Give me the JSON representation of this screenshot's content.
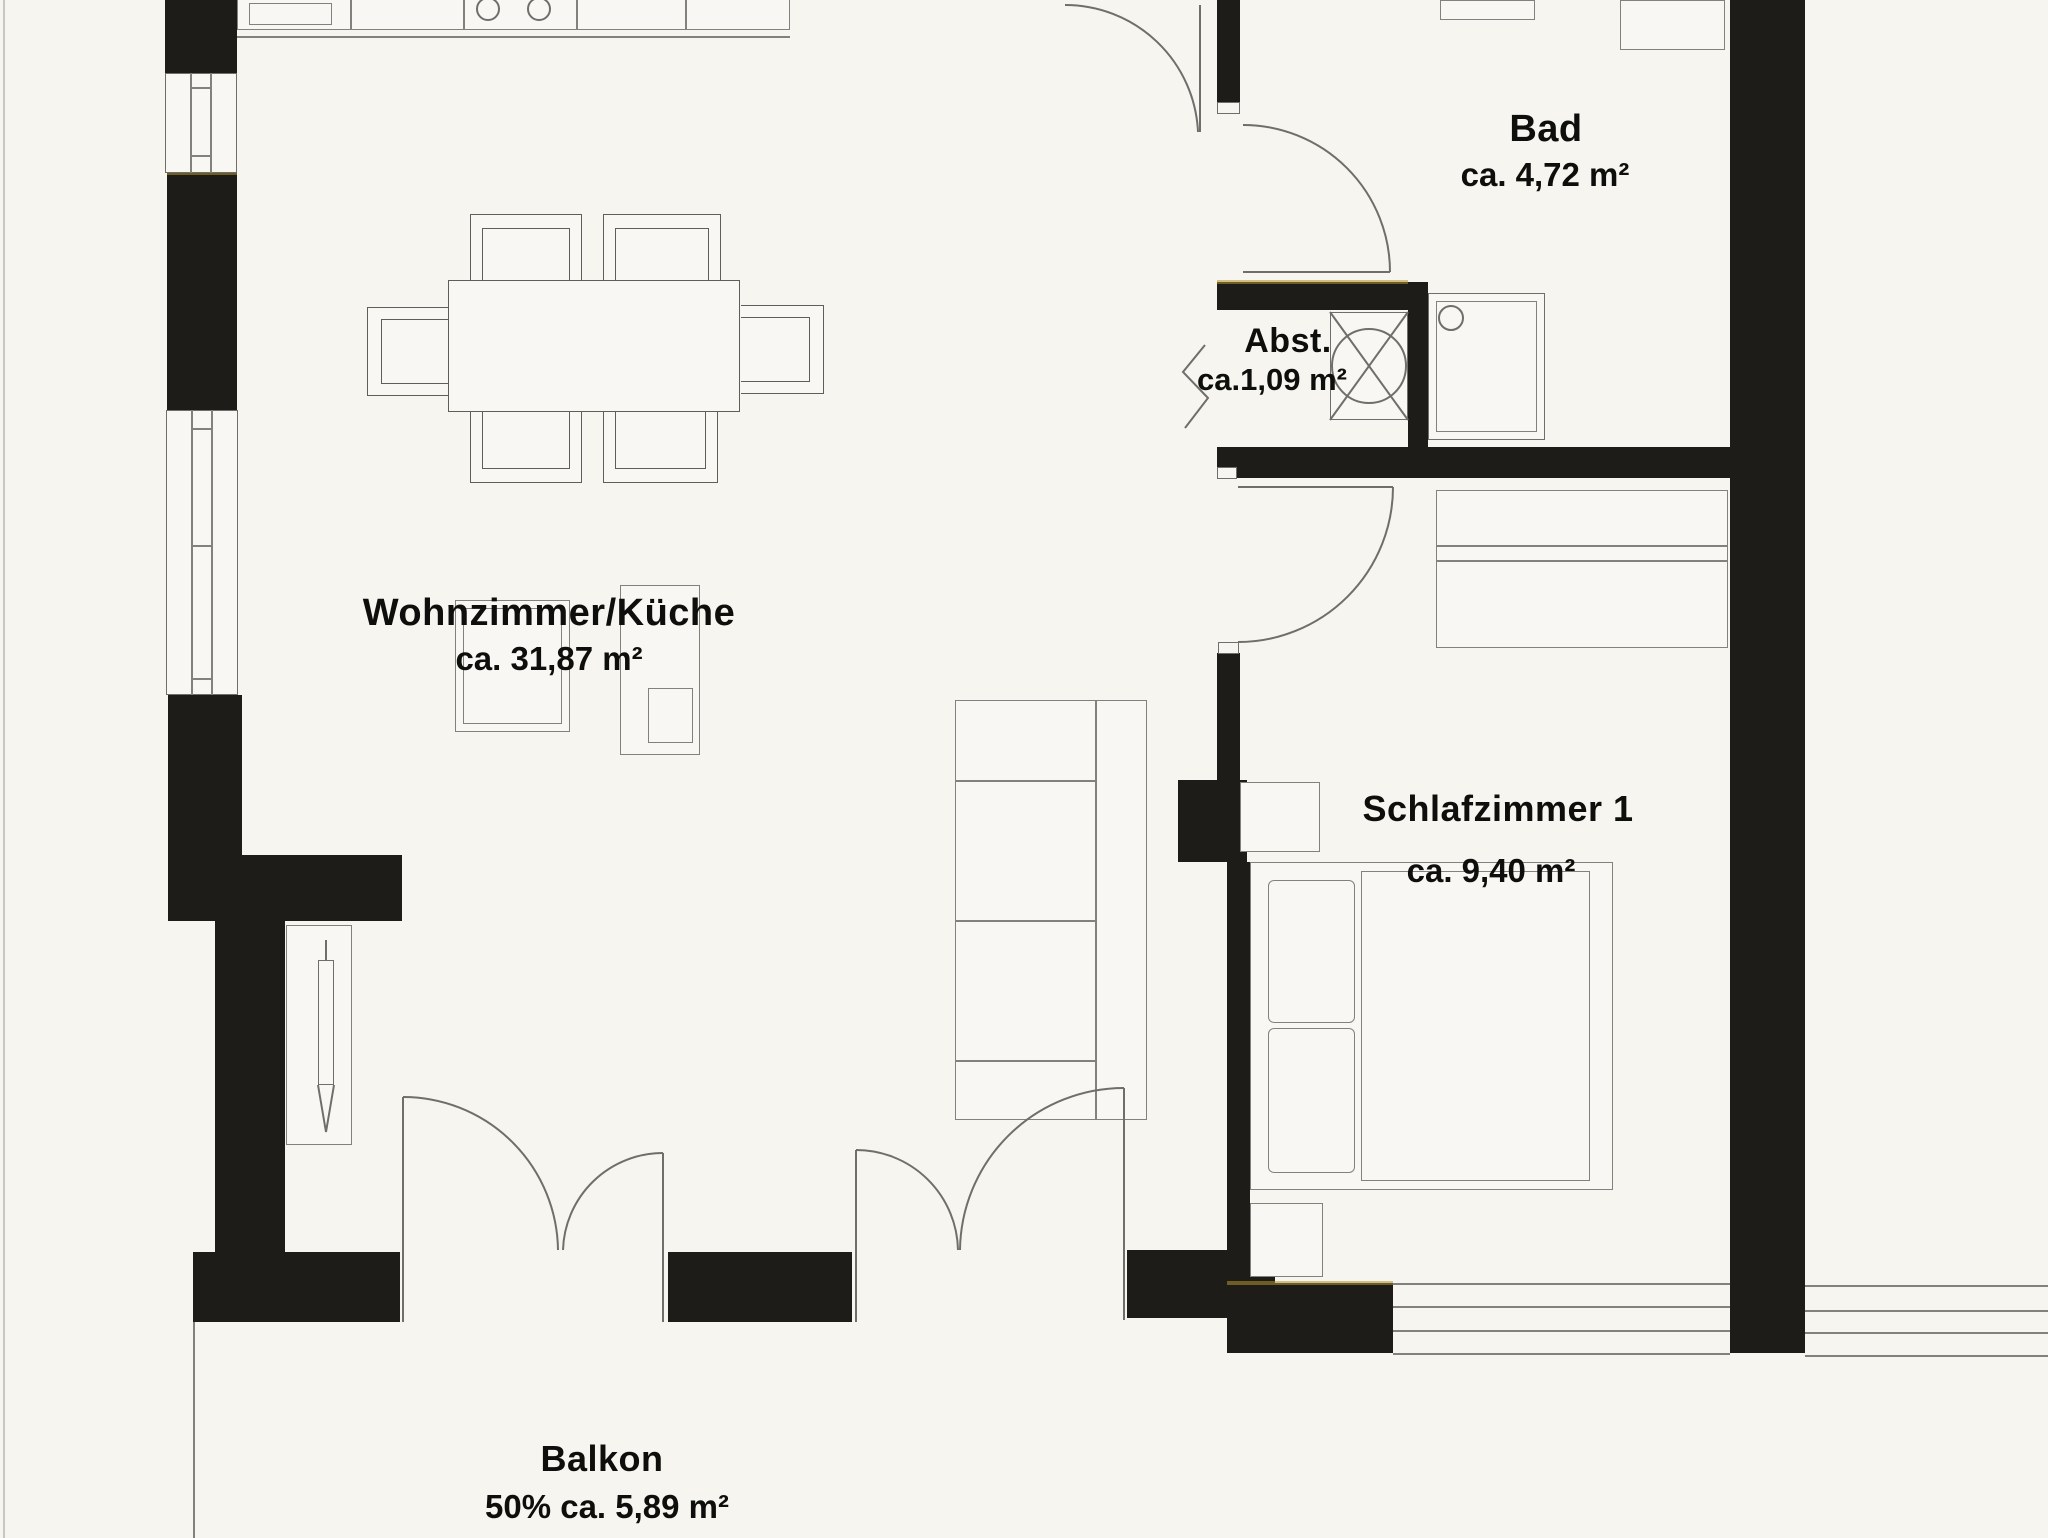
{
  "document": {
    "kind": "apartment floor plan scan"
  },
  "rooms": {
    "wohnzimmer": {
      "name": "Wohnzimmer/Küche",
      "area": "ca. 31,87 m²"
    },
    "bad": {
      "name": "Bad",
      "area": "ca. 4,72 m²"
    },
    "abstellraum": {
      "name": "Abst.",
      "area": "ca.1,09 m²"
    },
    "schlafzimmer": {
      "name": "Schlafzimmer 1",
      "area": "ca. 9,40 m²"
    },
    "balkon": {
      "name": "Balkon",
      "area": "50% ca. 5,89 m²"
    }
  }
}
